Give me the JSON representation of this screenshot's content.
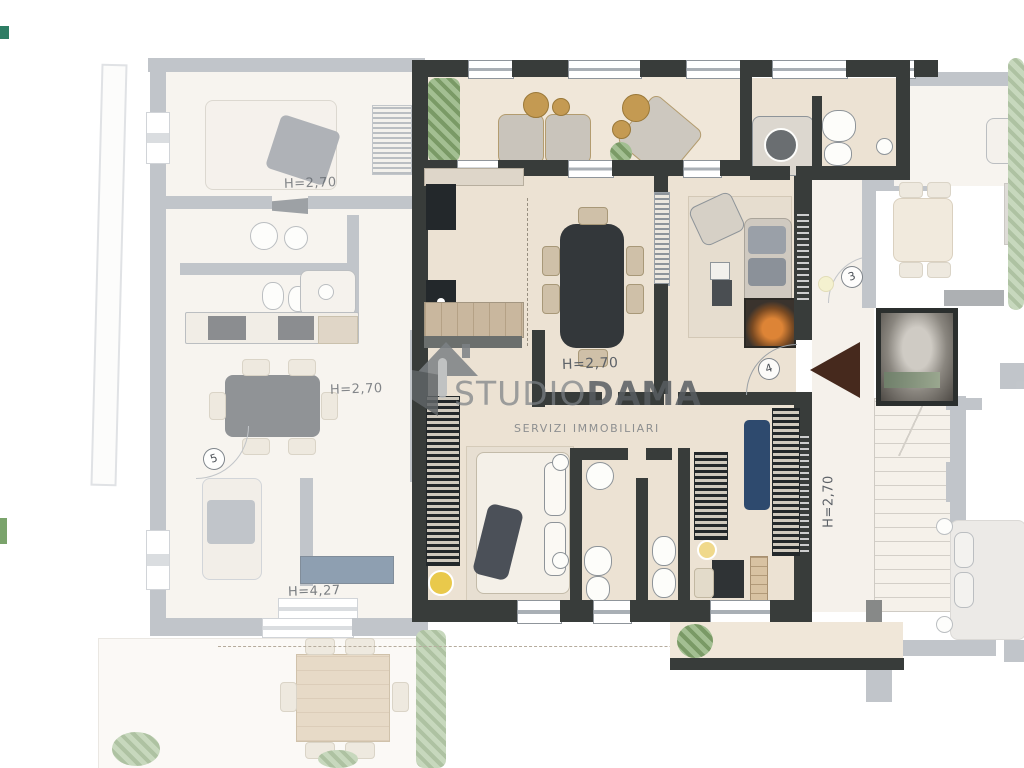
{
  "watermark": {
    "brand_a": "STUDIO",
    "brand_b": "DAMA",
    "tagline": "SERVIZI IMMOBILIARI"
  },
  "labels": {
    "left_bedroom_height": "H=2,70",
    "left_kitchen_height": "H=2,70",
    "left_living_height": "H=4,27",
    "main_hall_height": "H=2,70",
    "stair_hall_height": "H=2,70"
  },
  "door_tags": {
    "door_3": "3",
    "door_4": "4",
    "door_5": "5"
  },
  "colors": {
    "wall_dark": "#383c3a",
    "wall_faded": "#99a0a8",
    "floor_main": "#ece2d3",
    "floor_faded": "#f3eee6",
    "terrace_floor": "#f0e7d9",
    "hedge_green": "#84a470",
    "wood": "#d8c2a2",
    "furniture_dark": "#33373a",
    "bed_blue": "#2e4a6e",
    "arrow_brown": "#46291d",
    "lamp_yellow": "#e9c94b",
    "fire_orange": "#dd8436",
    "watermark_grey": "#7c8185",
    "label_ink": "#5c6167"
  }
}
